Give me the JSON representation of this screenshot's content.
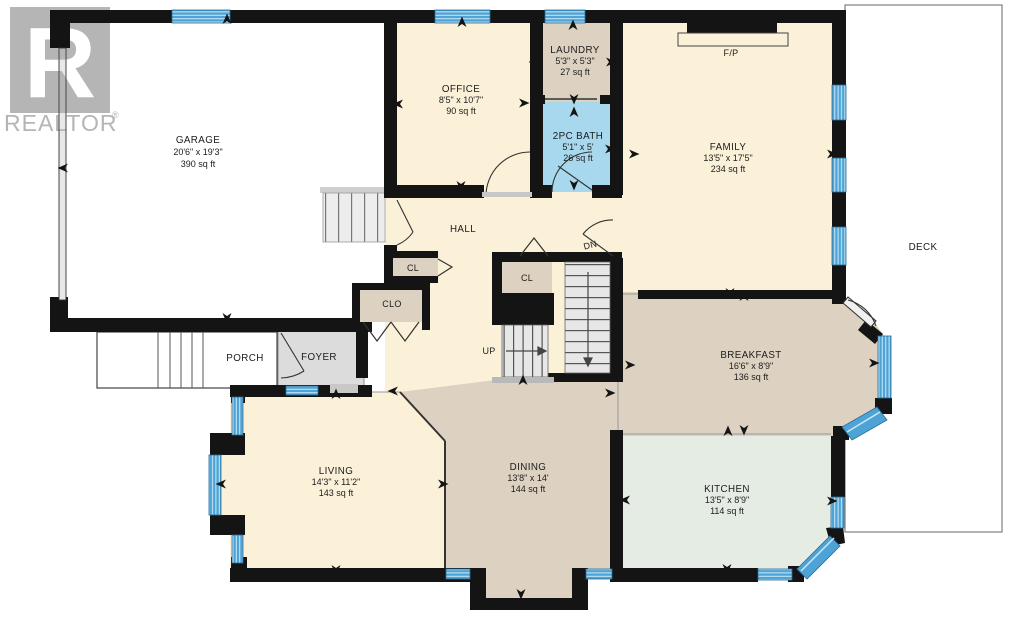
{
  "watermark": {
    "logo_letter": "R",
    "brand": "REALTOR",
    "registered": "®"
  },
  "rooms": {
    "garage": {
      "name": "GARAGE",
      "dims": "20'6\" x 19'3\"",
      "area": "390 sq ft"
    },
    "office": {
      "name": "OFFICE",
      "dims": "8'5\" x 10'7\"",
      "area": "90 sq ft"
    },
    "laundry": {
      "name": "LAUNDRY",
      "dims": "5'3\" x 5'3\"",
      "area": "27 sq ft"
    },
    "bath": {
      "name": "2PC BATH",
      "dims": "5'1\" x 5'",
      "area": "26 sq ft"
    },
    "family": {
      "name": "FAMILY",
      "dims": "13'5\" x 17'5\"",
      "area": "234 sq ft"
    },
    "breakfast": {
      "name": "BREAKFAST",
      "dims": "16'6\" x 8'9\"",
      "area": "136 sq ft"
    },
    "kitchen": {
      "name": "KITCHEN",
      "dims": "13'5\" x 8'9\"",
      "area": "114 sq ft"
    },
    "dining": {
      "name": "DINING",
      "dims": "13'8\" x 14'",
      "area": "144 sq ft"
    },
    "living": {
      "name": "LIVING",
      "dims": "14'3\" x 11'2\"",
      "area": "143 sq ft"
    },
    "deck": {
      "name": "DECK"
    },
    "hall": {
      "name": "HALL"
    },
    "porch": {
      "name": "PORCH"
    },
    "foyer": {
      "name": "FOYER"
    }
  },
  "small_labels": {
    "fp": "F/P",
    "cl_hall": "CL",
    "clo": "CLO",
    "cl_stairs": "CL",
    "up": "UP",
    "dn": "DN"
  },
  "colors": {
    "wall": "#141414",
    "window_blue": "#4da3d6",
    "window_stripe": "#cfe9f7",
    "cream": "#faf1d8",
    "tan": "#ddd2c1",
    "bath_blue": "#a8d8ee",
    "kitchen_green": "#e5ece4",
    "foyer_gray": "#dcdcdc",
    "stairs_gray": "#e7e7e7",
    "watermark_gray": "#b5b5b5"
  },
  "arrows": [
    {
      "x": 227,
      "y": 24,
      "d": "up"
    },
    {
      "x": 68,
      "y": 168,
      "d": "left"
    },
    {
      "x": 462,
      "y": 27,
      "d": "up"
    },
    {
      "x": 573,
      "y": 30,
      "d": "up"
    },
    {
      "x": 730,
      "y": 29,
      "d": "up"
    },
    {
      "x": 403,
      "y": 104,
      "d": "left"
    },
    {
      "x": 519,
      "y": 103,
      "d": "right"
    },
    {
      "x": 539,
      "y": 62,
      "d": "left"
    },
    {
      "x": 606,
      "y": 62,
      "d": "right"
    },
    {
      "x": 574,
      "y": 94,
      "d": "down"
    },
    {
      "x": 574,
      "y": 117,
      "d": "up"
    },
    {
      "x": 540,
      "y": 149,
      "d": "left"
    },
    {
      "x": 605,
      "y": 149,
      "d": "right"
    },
    {
      "x": 629,
      "y": 154,
      "d": "right"
    },
    {
      "x": 461,
      "y": 181,
      "d": "down"
    },
    {
      "x": 574,
      "y": 180,
      "d": "down"
    },
    {
      "x": 827,
      "y": 154,
      "d": "right"
    },
    {
      "x": 227,
      "y": 313,
      "d": "down"
    },
    {
      "x": 336,
      "y": 399,
      "d": "up"
    },
    {
      "x": 398,
      "y": 391,
      "d": "left"
    },
    {
      "x": 730,
      "y": 288,
      "d": "down"
    },
    {
      "x": 744,
      "y": 301,
      "d": "up"
    },
    {
      "x": 625,
      "y": 365,
      "d": "right"
    },
    {
      "x": 869,
      "y": 363,
      "d": "right"
    },
    {
      "x": 744,
      "y": 425,
      "d": "down"
    },
    {
      "x": 728,
      "y": 436,
      "d": "up"
    },
    {
      "x": 630,
      "y": 500,
      "d": "left"
    },
    {
      "x": 827,
      "y": 501,
      "d": "right"
    },
    {
      "x": 727,
      "y": 564,
      "d": "down"
    },
    {
      "x": 226,
      "y": 484,
      "d": "left"
    },
    {
      "x": 438,
      "y": 484,
      "d": "right"
    },
    {
      "x": 336,
      "y": 565,
      "d": "down"
    },
    {
      "x": 521,
      "y": 589,
      "d": "down"
    },
    {
      "x": 523,
      "y": 385,
      "d": "up"
    },
    {
      "x": 605,
      "y": 393,
      "d": "right"
    }
  ]
}
